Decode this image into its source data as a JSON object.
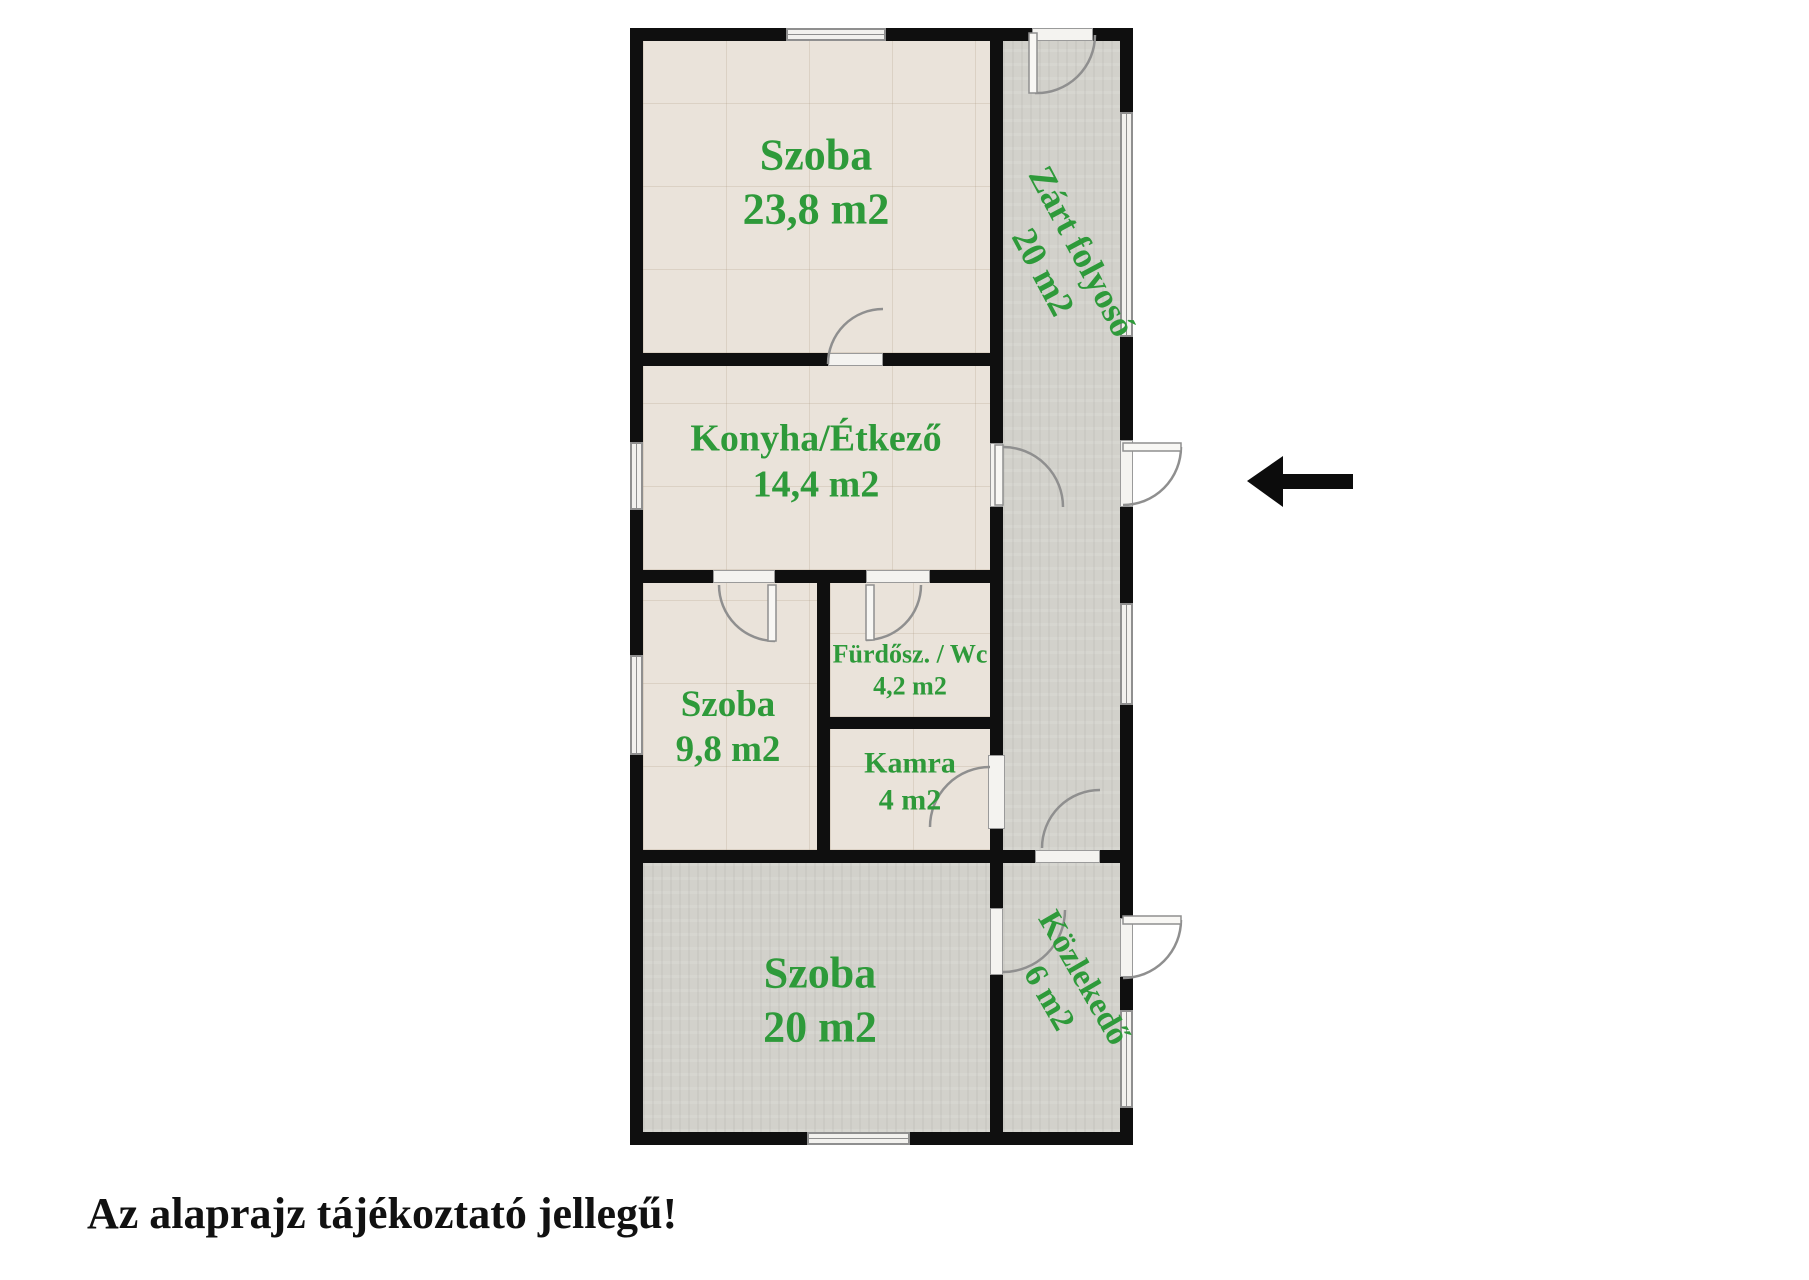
{
  "note": "Az alaprajz tájékoztató jellegű!",
  "rooms": [
    {
      "id": "szoba-nagy",
      "name": "Szoba",
      "area": "23,8 m2"
    },
    {
      "id": "konyha-etkezo",
      "name": "Konyha/Étkező",
      "area": "14,4 m2"
    },
    {
      "id": "szoba-kozepes",
      "name": "Szoba",
      "area": "9,8 m2"
    },
    {
      "id": "furdoszoba-wc",
      "name": "Fürdősz. / Wc",
      "area": "4,2 m2"
    },
    {
      "id": "kamra",
      "name": "Kamra",
      "area": "4 m2"
    },
    {
      "id": "szoba-also",
      "name": "Szoba",
      "area": "20 m2"
    },
    {
      "id": "zart-folyoso",
      "name": "Zárt folyosó",
      "area": "20 m2"
    },
    {
      "id": "kozlekedo",
      "name": "Közlekedő",
      "area": "6 m2"
    }
  ],
  "icons": {
    "entrance_arrow": "left-arrow"
  },
  "colors": {
    "room_label_green": "#2e9a3a",
    "wall": "#0f0f0f",
    "floor_tile_beige": "#eae3da",
    "floor_gray": "#d2d1cb",
    "door_window_line": "#8f8f8f",
    "note_text": "#111111"
  }
}
